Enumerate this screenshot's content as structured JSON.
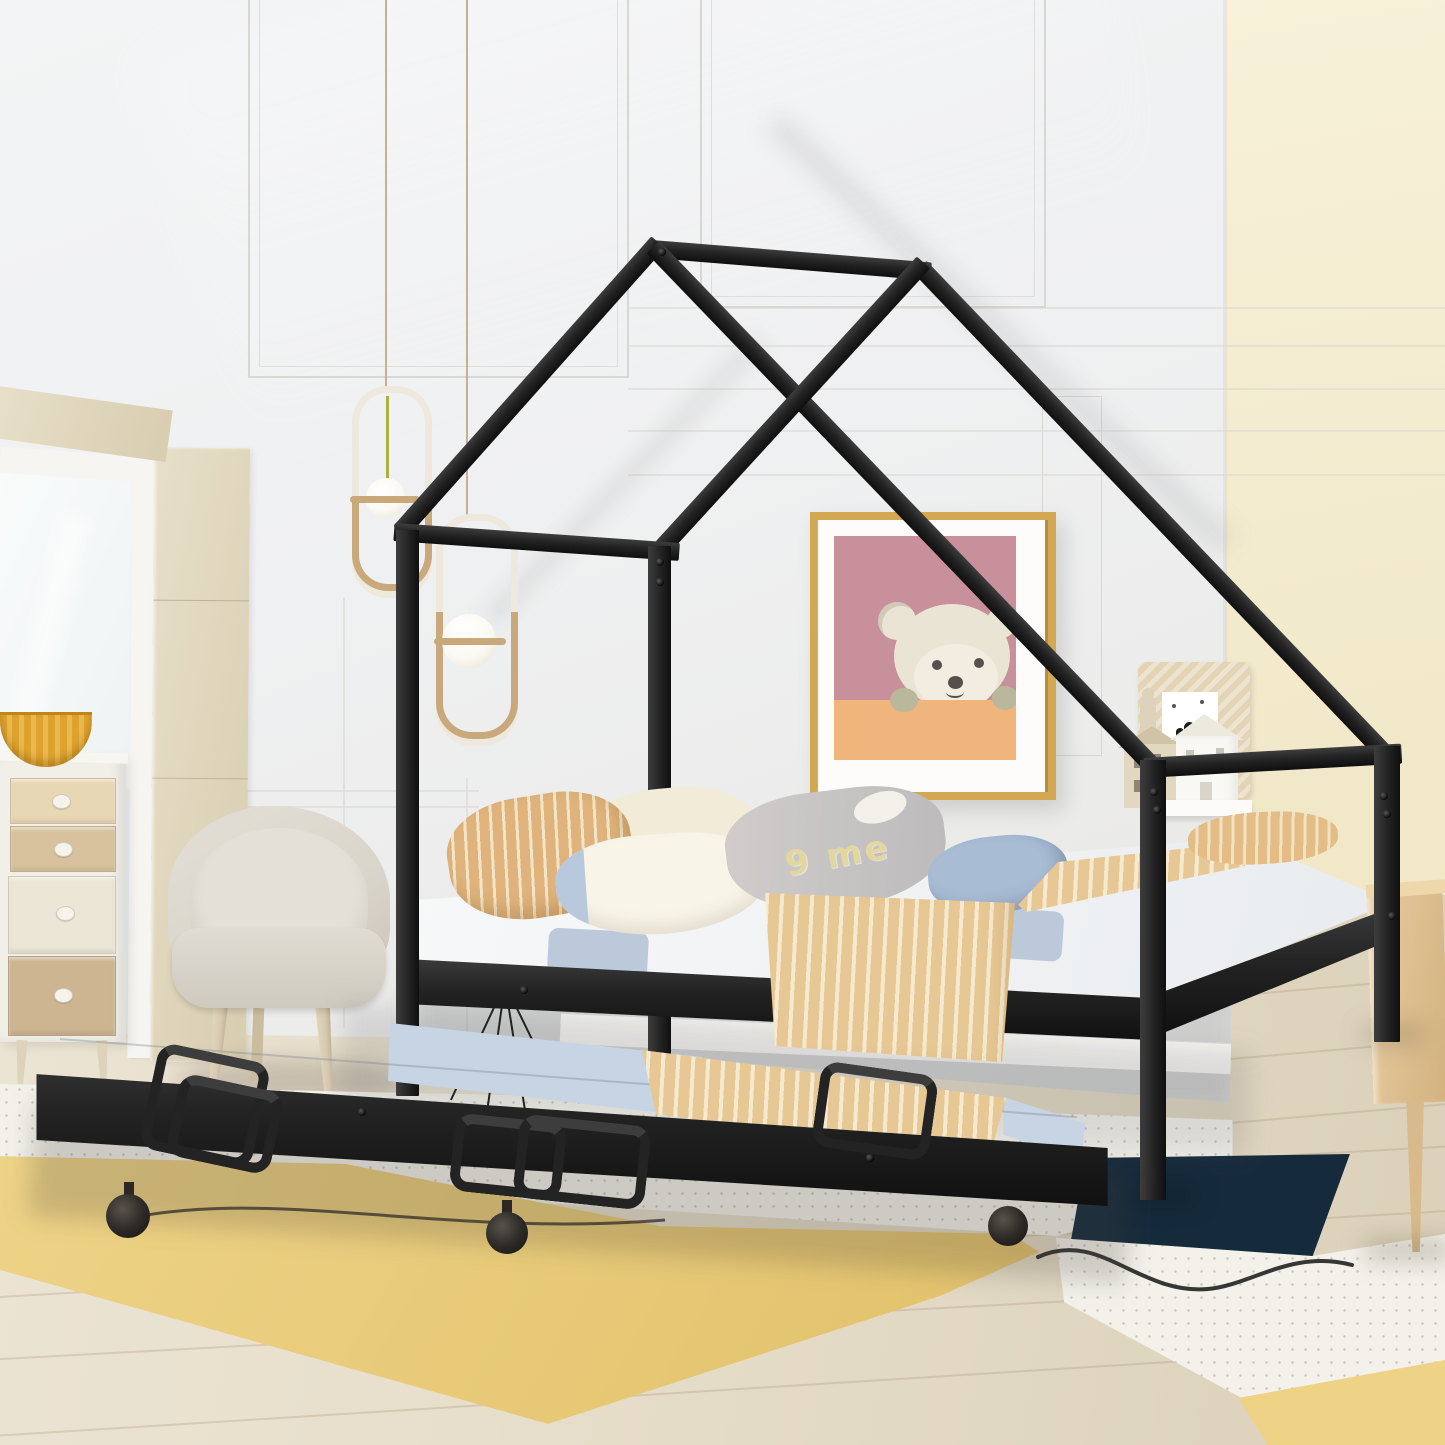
{
  "scene": {
    "description": "Bedroom lifestyle photo of a black metal house-shaped kids bed with pull-out trundle on casters, styled with pillows, tan striped blankets, pendant lights, teddy-bear wall art, dresser, chair, yellow rug and light wood floor",
    "objects": [
      "house-frame-bed",
      "trundle-bed",
      "window",
      "dresser",
      "chair",
      "pendant-lights",
      "teddy-bear-artwork",
      "shelf-decor-houses",
      "area-rug",
      "nightstand",
      "wire-tripod-decor"
    ]
  },
  "objects": {
    "bed": {
      "label": "black metal house-frame daybed"
    },
    "trundle": {
      "label": "pull-out trundle with casters and fold handles"
    },
    "text_pillow": {
      "text": "9 me"
    },
    "artwork": {
      "label": "teddy bear print in gold frame"
    },
    "pendants": {
      "count": 2,
      "label": "paperclip pendant lights with glass orbs"
    }
  },
  "palette": {
    "wall_left": "#eff0f1",
    "wall_left_deep": "#e7e6e2",
    "wall_right": "#f7f1d9",
    "wall_right_deep": "#f1e8c8",
    "molding": "#d8d7d2",
    "baseboard": "#f4f3ef",
    "floor_light": "#ece4d3",
    "floor_mid": "#e5dcc8",
    "floor_deep": "#dbd1ba",
    "plank": "rgba(165,145,110,0.28)",
    "window_wood": "#e7dfc9",
    "window_wood_deep": "#d8cdb0",
    "window_frame": "#f6f5f1",
    "glass_hi": "#f9fbfb",
    "glass_lo": "#e9eff0",
    "metal_hi": "#3d3d3d",
    "metal": "#232323",
    "metal_deep": "#0f0f0f",
    "bolt": "#090909",
    "mattress_hi": "#f7f8f9",
    "mattress_lo": "#e9ecef",
    "sheet_blue": "#b7c6d9",
    "pillow_tan": "#dfb37b",
    "pillow_tan_stripe": "#f3e6c8",
    "pillow_cream": "#f2ebd7",
    "pillow_white": "#f8f4e8",
    "pillow_trim": "#b9c9dd",
    "pillow_gray_hi": "#d0cdcb",
    "pillow_gray_lo": "#bcbabb",
    "pillow_letters": "#e3d7a0",
    "pillow_blue": "#a8bcd4",
    "blanket": "#e7c894",
    "blanket_stripe": "#f5ead0",
    "trundle_blue": "#c6d4e4",
    "rug_yellow": "#eed387",
    "rug_yellow_deep": "#e2c26c",
    "rug_white": "#f3f1ea",
    "rug_navy": "#152a3b",
    "squiggle": "#1b1b1b",
    "nightstand_hi": "#e8cda2",
    "nightstand_lo": "#d2b17e",
    "dresser_body": "#f1efe8",
    "drawer_a": "#e8d7b4",
    "drawer_b": "#d8c29e",
    "drawer_c": "#ece6d6",
    "drawer_d": "#cdb592",
    "knob": "#f6f3ea",
    "bowl": "#dda32e",
    "bowl_deep": "#c08418",
    "chair_shell": "#d9d5cb",
    "chair_cushion": "#e4e0d7",
    "chair_leg": "#d7cab1",
    "pendant_gold": "#c9a97c",
    "pendant_tube": "#eee9dc",
    "pendant_green": "#a9b23e",
    "orb": "#fbf9f3",
    "art_gold": "#d2a852",
    "art_mat": "#fdfcfa",
    "art_mauve": "#c8909b",
    "art_orange": "#efb57d",
    "bear_body": "#eae4d4",
    "bear_muzzle": "#f2ede0",
    "bear_dark": "#55504a",
    "bear_paw": "#b9b79c",
    "woven": "#e4d4b6",
    "decor_white": "#f9f8f5",
    "decor_wood": "#ddd3bd",
    "cable": "#c5b28c"
  }
}
